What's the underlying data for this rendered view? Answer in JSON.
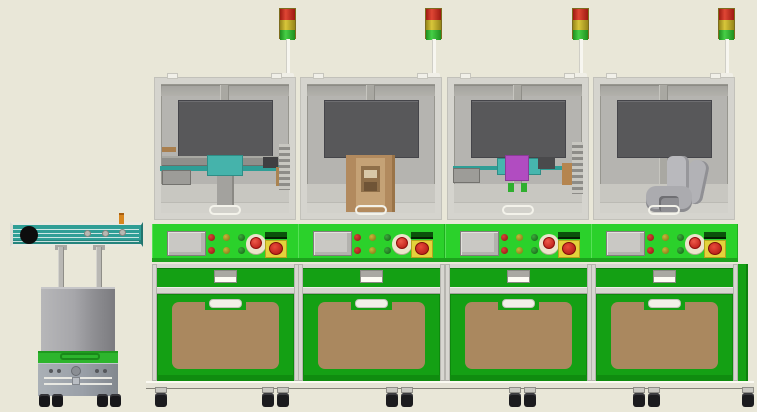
{
  "scene": {
    "description": "3D CAD render of an automated production line: four green machine stations with tri-color signal towers and an AGV shuttle cart on the left",
    "background_color": "#e9e7d8"
  },
  "agv": {
    "name": "agv-shuttle-cart",
    "parts": [
      "top-conveyor-rail",
      "drive-pulley",
      "rollers",
      "support-masts",
      "lift-body",
      "green-band",
      "chassis",
      "wheels"
    ],
    "conveyor_color": "#2f9e96",
    "band_color": "#2db52d",
    "body_color": "#9a9a9e"
  },
  "stations": [
    {
      "name": "station-1",
      "x": 152,
      "equipment": "cyan-conveyor-unit"
    },
    {
      "name": "station-2",
      "x": 298,
      "equipment": "tan-fixture-unit"
    },
    {
      "name": "station-3",
      "x": 445,
      "equipment": "magenta-head-unit"
    },
    {
      "name": "station-4",
      "x": 591,
      "equipment": "robot-arm-unit"
    }
  ],
  "station_parts": {
    "signal_tower": {
      "segments": [
        "red",
        "yellow",
        "green"
      ],
      "segment_colors": [
        "#c32a20",
        "#ccbb2b",
        "#33bd33"
      ]
    },
    "enclosure": {
      "frame_color": "#d5d4ce",
      "interior_color": "#b5b4b0",
      "screen_color": "#58585a"
    },
    "control_panel": {
      "strip_color": "#2bd12b",
      "hmi_color": "#c9c8c4",
      "indicator_grid": {
        "rows": 2,
        "columns": 3,
        "colors": [
          "#a81d1d",
          "#97851c",
          "#1d7d1d"
        ]
      },
      "estop_colors": {
        "ring": "#ece4cb",
        "button": "#d32626"
      },
      "main_switch_colors": {
        "header": "#0b520b",
        "body": "#e4d23b",
        "knob": "#ce2525"
      }
    },
    "cabinet": {
      "green": "#14a014",
      "door_panel_color": "#aa885f",
      "handle_color": "#f1f0e8"
    }
  },
  "base": {
    "caster_count": 10,
    "caster_x": [
      154,
      261,
      276,
      385,
      400,
      508,
      523,
      632,
      647,
      741
    ]
  }
}
